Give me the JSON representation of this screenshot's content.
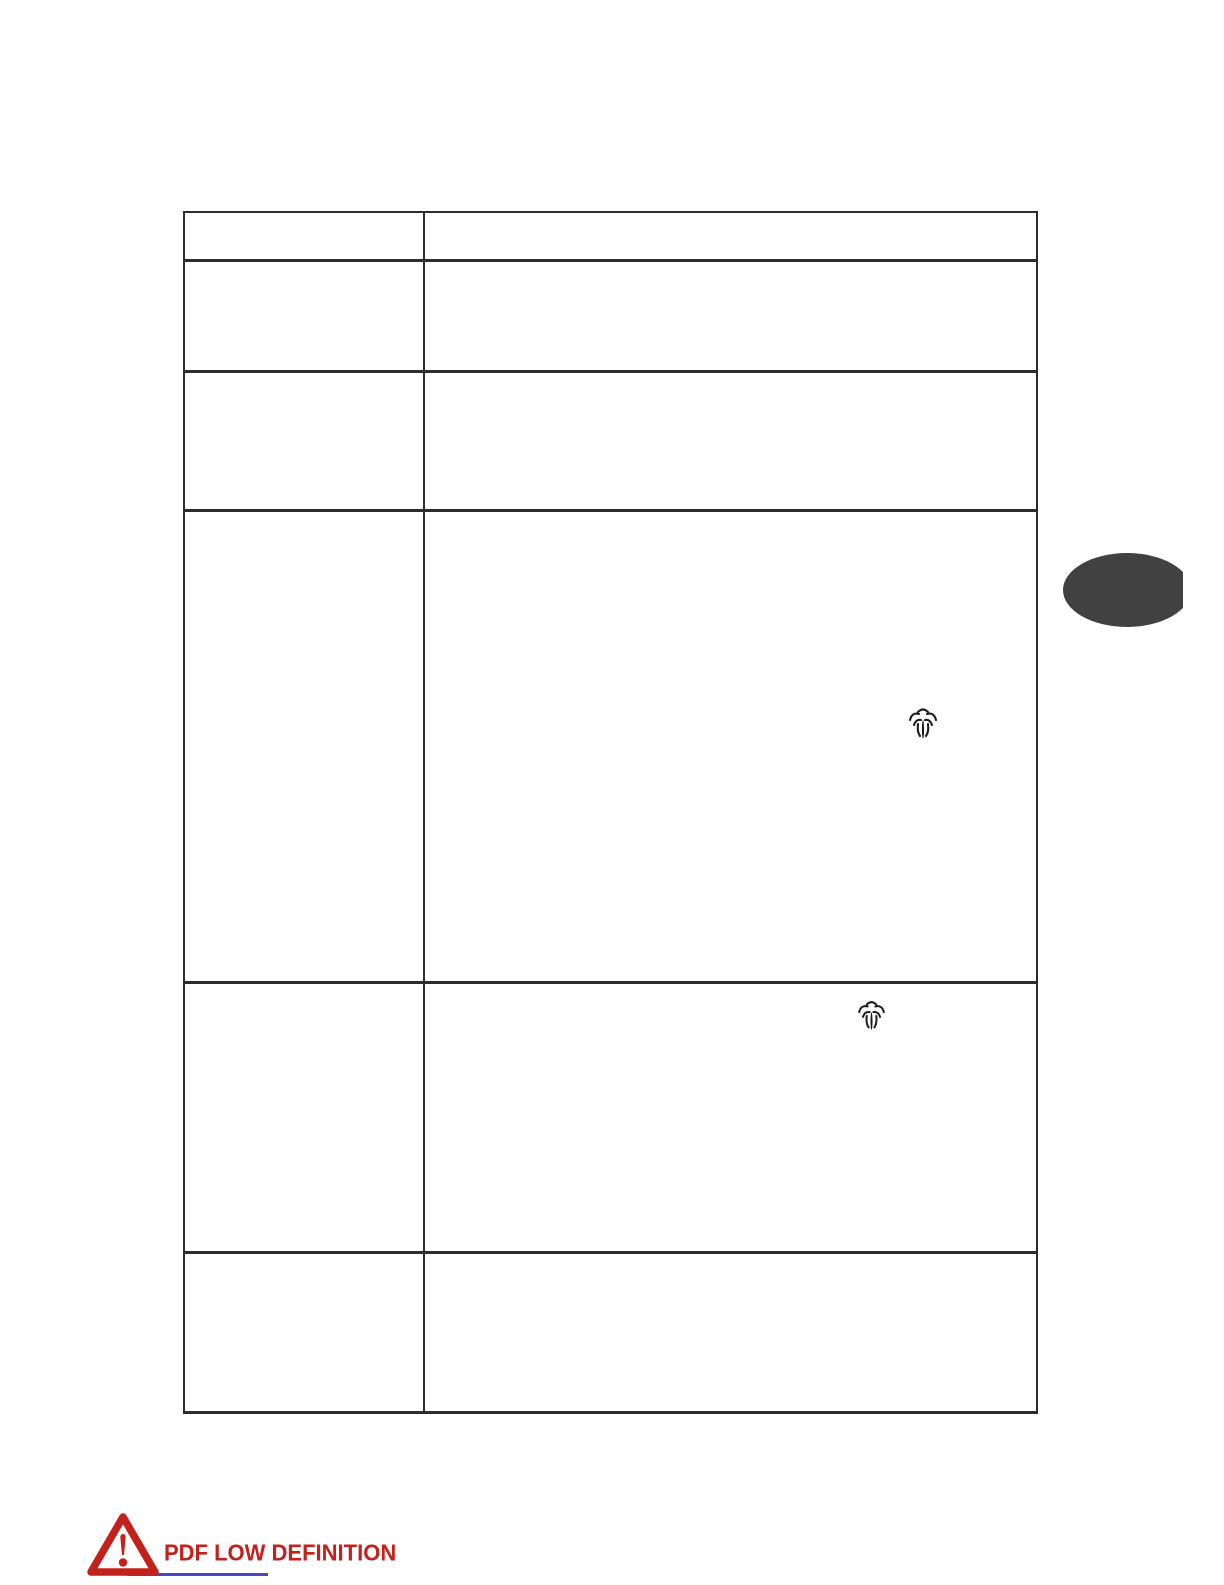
{
  "document": {
    "kind": "scanned manual page (content not rendered / low definition)",
    "background_color": "#ffffff"
  },
  "table": {
    "border_color": "#2d2d2d",
    "column_count": 2,
    "rows": [
      {
        "left": "",
        "right": ""
      },
      {
        "left": "",
        "right": ""
      },
      {
        "left": "",
        "right": ""
      },
      {
        "left": "",
        "right": "",
        "right_icon": "steam-burst-icon"
      },
      {
        "left": "",
        "right": "",
        "right_icon": "steam-burst-icon"
      },
      {
        "left": "",
        "right": ""
      }
    ]
  },
  "side_badge": {
    "shape": "ellipse",
    "color": "#414141"
  },
  "warning_banner": {
    "text": "PDF LOW DEFINITION",
    "text_color": "#c3211c",
    "triangle_color": "#c3211c",
    "underline_color": "#3333cc",
    "icon": "warning-triangle-icon"
  }
}
